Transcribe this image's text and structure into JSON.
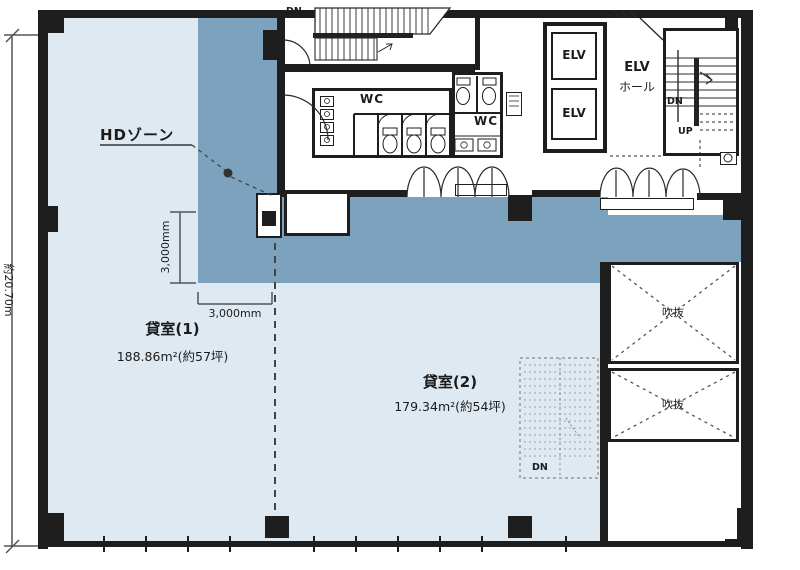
{
  "meta": {
    "drawing_type": "floor-plan"
  },
  "colors": {
    "zone_blue": "#7da2bd",
    "tenant_blue": "#dfe9f1",
    "wall": "#1e1e1e"
  },
  "dimensions": {
    "total_height": "約20.70m",
    "zone_depth_vertical": "3,000mm",
    "zone_width_horizontal": "3,000mm"
  },
  "zone": {
    "label": "HDゾーン"
  },
  "rooms": {
    "room1": {
      "name": "貸室(1)",
      "area": "188.86m²(約57坪)"
    },
    "room2": {
      "name": "貸室(2)",
      "area": "179.34m²(約54坪)"
    }
  },
  "core": {
    "wc1": "WC",
    "wc2": "WC",
    "elv1": "ELV",
    "elv2": "ELV",
    "elv_hall1": "ELV",
    "elv_hall2": "ホール",
    "dn_top": "DN",
    "dn_main": "DN",
    "up_main": "UP",
    "dn_future": "DN",
    "void1": "吹抜",
    "void2": "吹抜"
  }
}
